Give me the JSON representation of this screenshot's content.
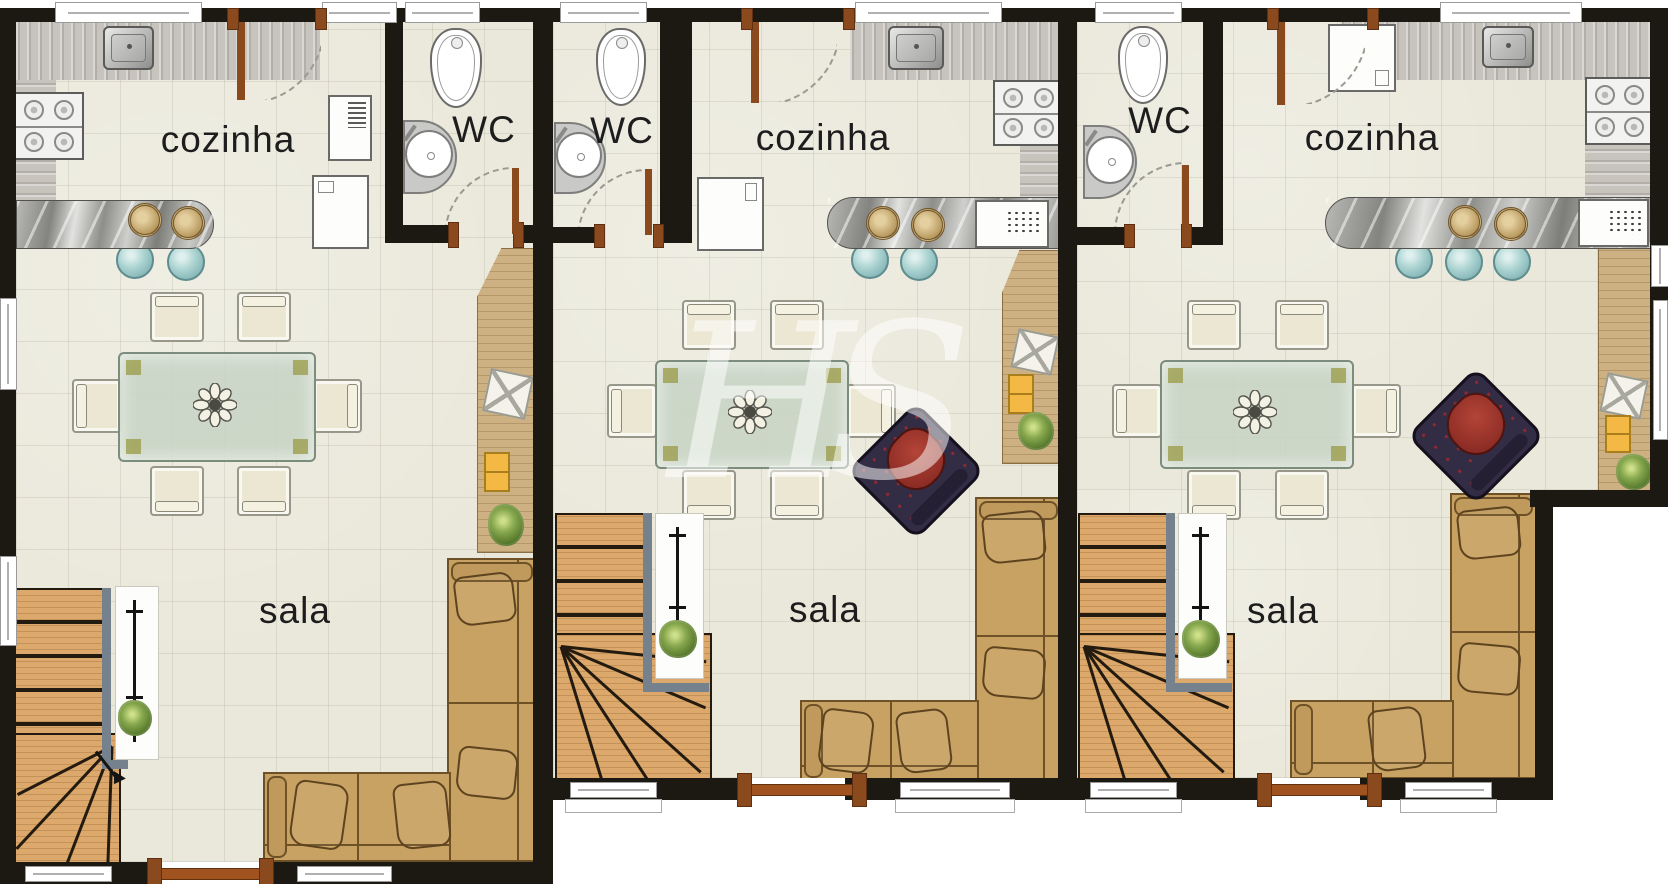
{
  "floorplan": {
    "watermark": "HS",
    "units": [
      {
        "name": "unit-1",
        "kitchen_label": "cozinha",
        "wc_label": "WC",
        "living_label": "sala"
      },
      {
        "name": "unit-2",
        "kitchen_label": "cozinha",
        "wc_label": "WC",
        "living_label": "sala"
      },
      {
        "name": "unit-3",
        "kitchen_label": "cozinha",
        "wc_label": "WC",
        "living_label": "sala"
      }
    ],
    "colors": {
      "wall": "#1c1812",
      "floor_tile": "#eae8da",
      "stair_wood": "#dca86b",
      "deck_wood": "#cdb183",
      "sofa": "#c8a263",
      "counter": "#c7c3bd",
      "marble": "#8e8e8a",
      "stool": "#a9d2d0",
      "glass_table": "#c7d4c5",
      "armchair": "#322c44",
      "armchair_cushion": "#a13a31",
      "accent_yellow": "#f4b944",
      "plant": "#4e7026",
      "door": "#8a4a1e",
      "label_text": "#1d1d1d"
    }
  }
}
